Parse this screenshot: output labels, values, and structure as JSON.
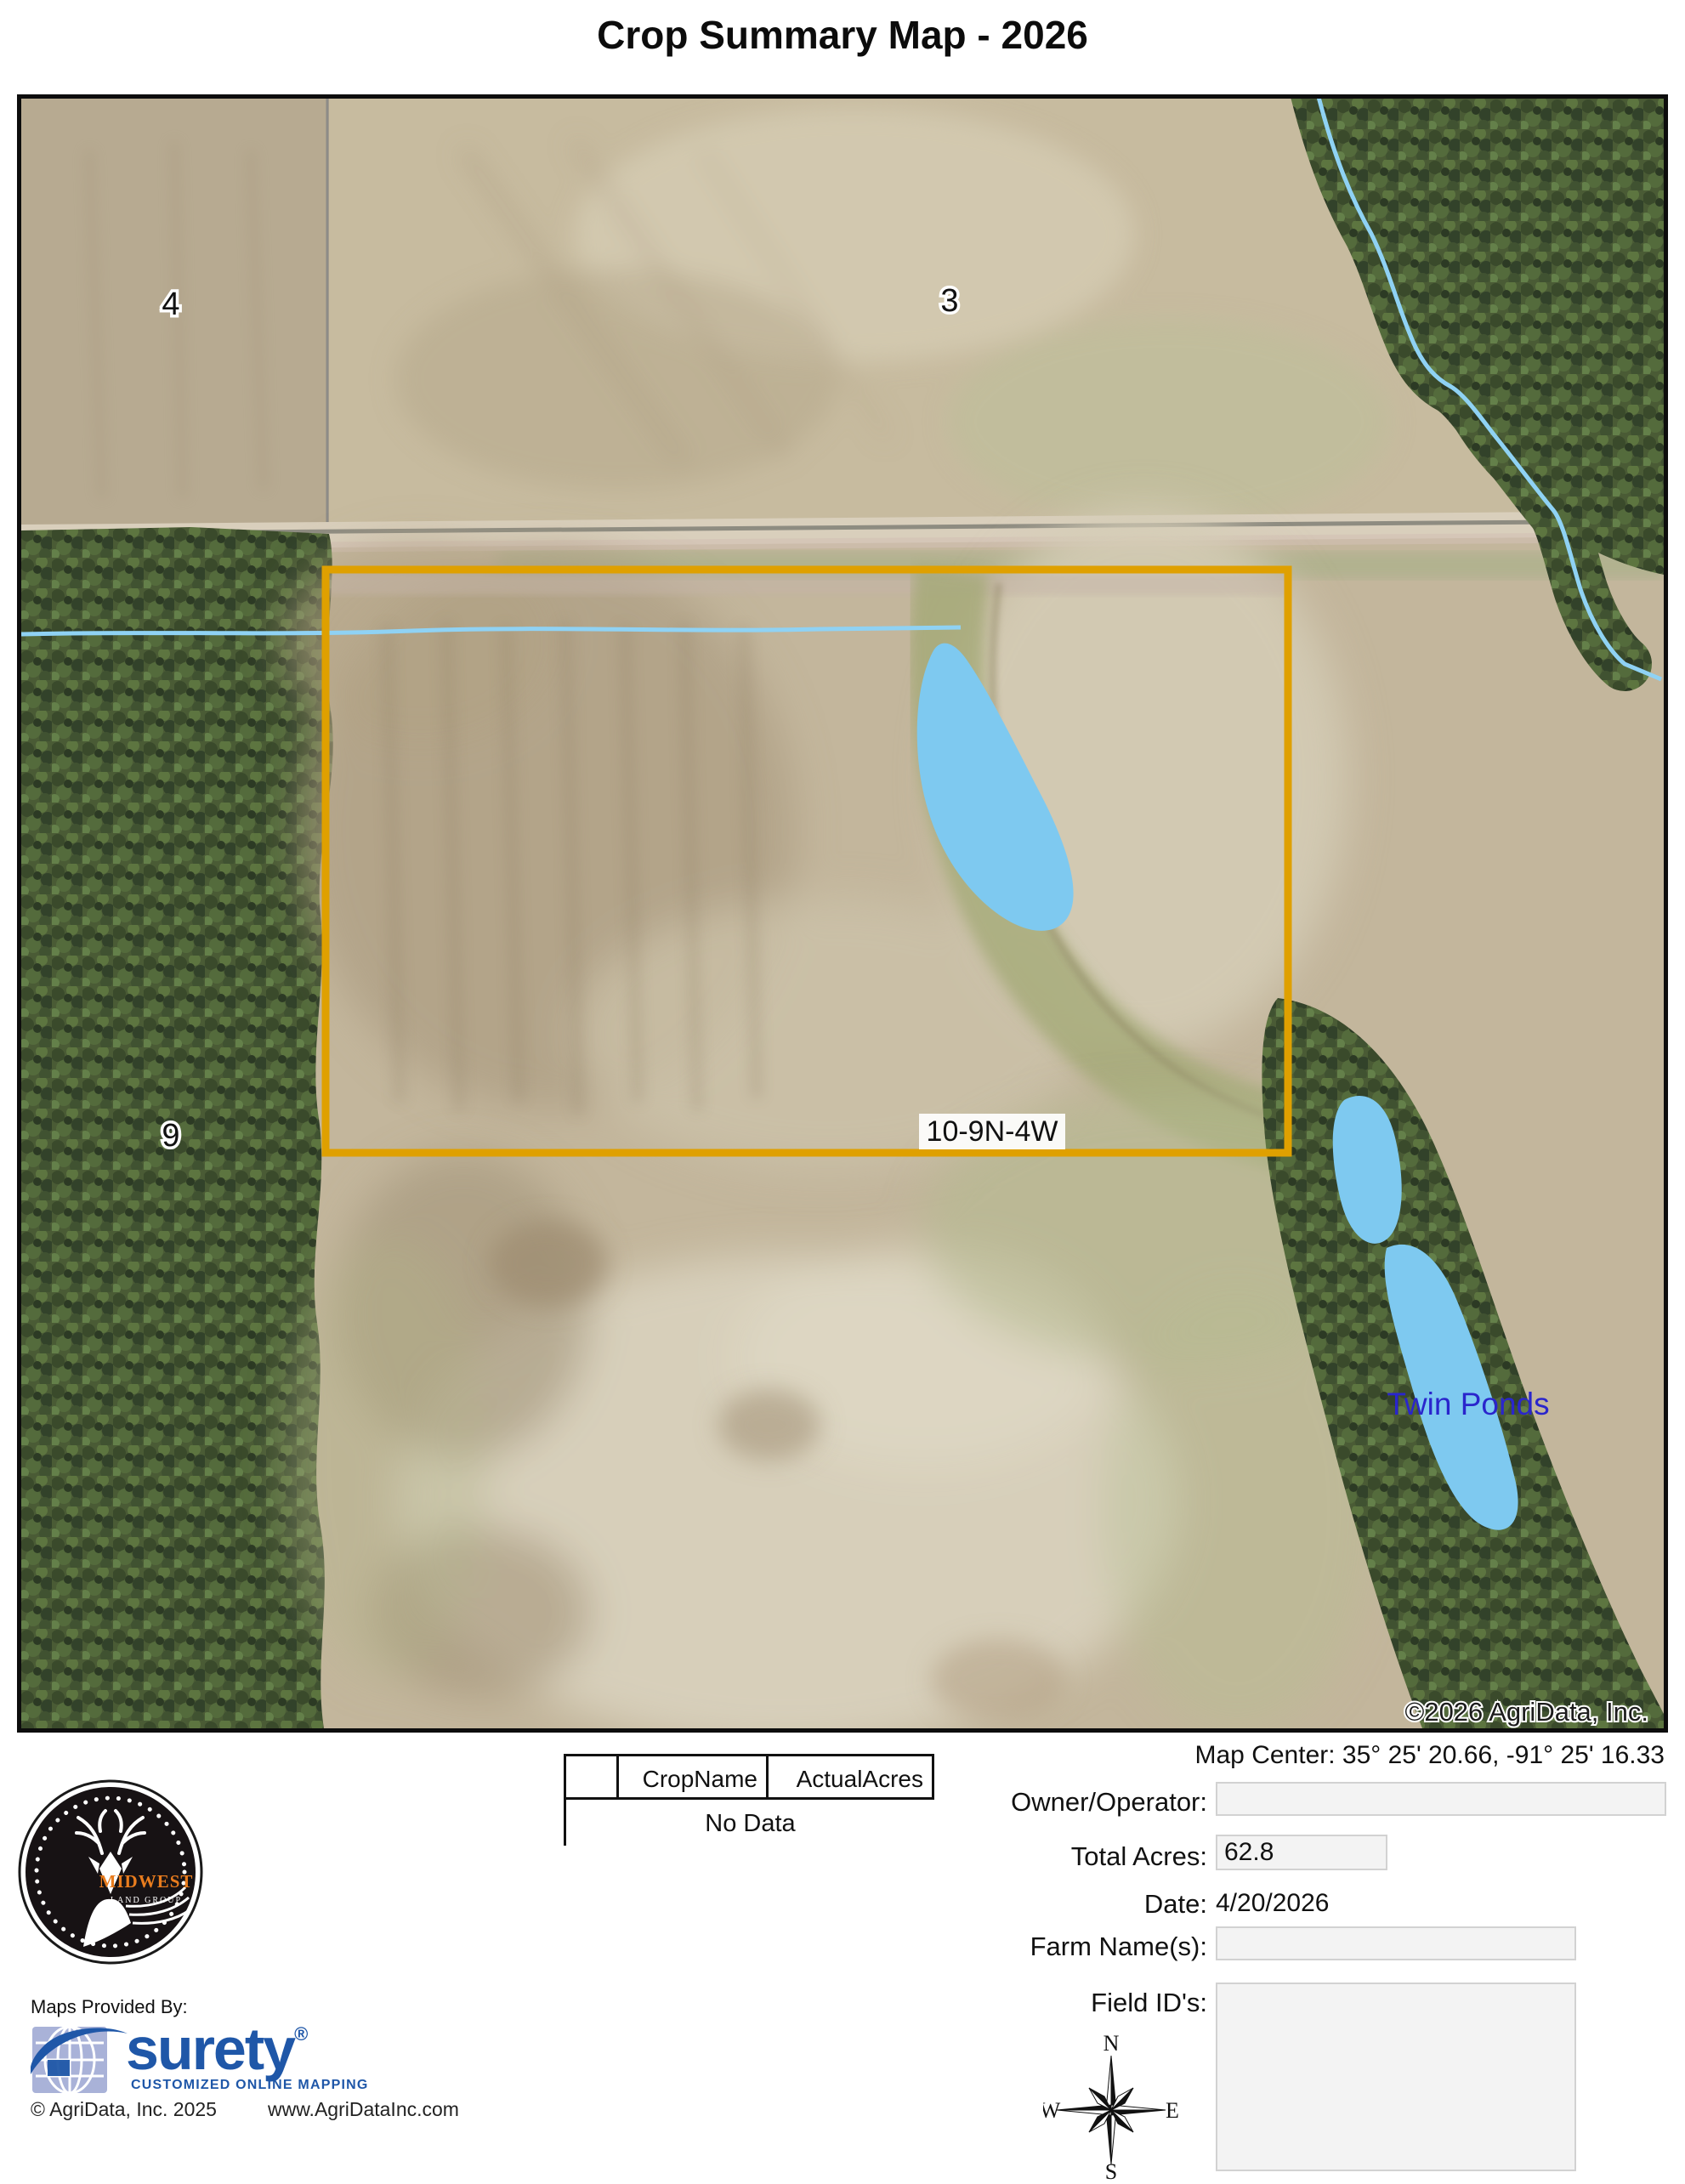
{
  "title": "Crop Summary Map - 2026",
  "map": {
    "labels": {
      "section_4": "4",
      "section_3": "3",
      "section_9": "9",
      "plss": "10-9N-4W",
      "twin_ponds": "Twin Ponds",
      "copyright": "©2026 AgriData, Inc."
    },
    "colors": {
      "boundary": "#DFA000",
      "pond": "#7EC9F0",
      "stream": "#8FD2F4",
      "twin_ponds_label": "#2A25CC"
    }
  },
  "info": {
    "map_center_label": "Map Center:",
    "map_center_value": "35° 25' 20.66,  -91° 25' 16.33",
    "owner_label": "Owner/Operator:",
    "owner_value": "",
    "total_acres_label": "Total Acres:",
    "total_acres_value": "62.8",
    "date_label": "Date:",
    "date_value": "4/20/2026",
    "farm_label": "Farm Name(s):",
    "farm_value": "",
    "field_ids_label": "Field ID's:",
    "field_ids_value": ""
  },
  "table": {
    "headers": [
      "",
      "CropName",
      "ActualAcres"
    ],
    "empty": "No Data"
  },
  "compass": {
    "n": "N",
    "e": "E",
    "s": "S",
    "w": "W"
  },
  "branding": {
    "midwest": {
      "name": "MIDWEST",
      "subtitle": "LAND GROUP",
      "orange": "#E87C1E"
    },
    "provided_by": "Maps Provided By:",
    "surety": {
      "name": "surety",
      "registered": "®",
      "tagline": "CUSTOMIZED ONLINE MAPPING",
      "blue": "#1F57A8"
    },
    "agridata_copyright": "© AgriData, Inc. 2025",
    "website": "www.AgriDataInc.com"
  }
}
